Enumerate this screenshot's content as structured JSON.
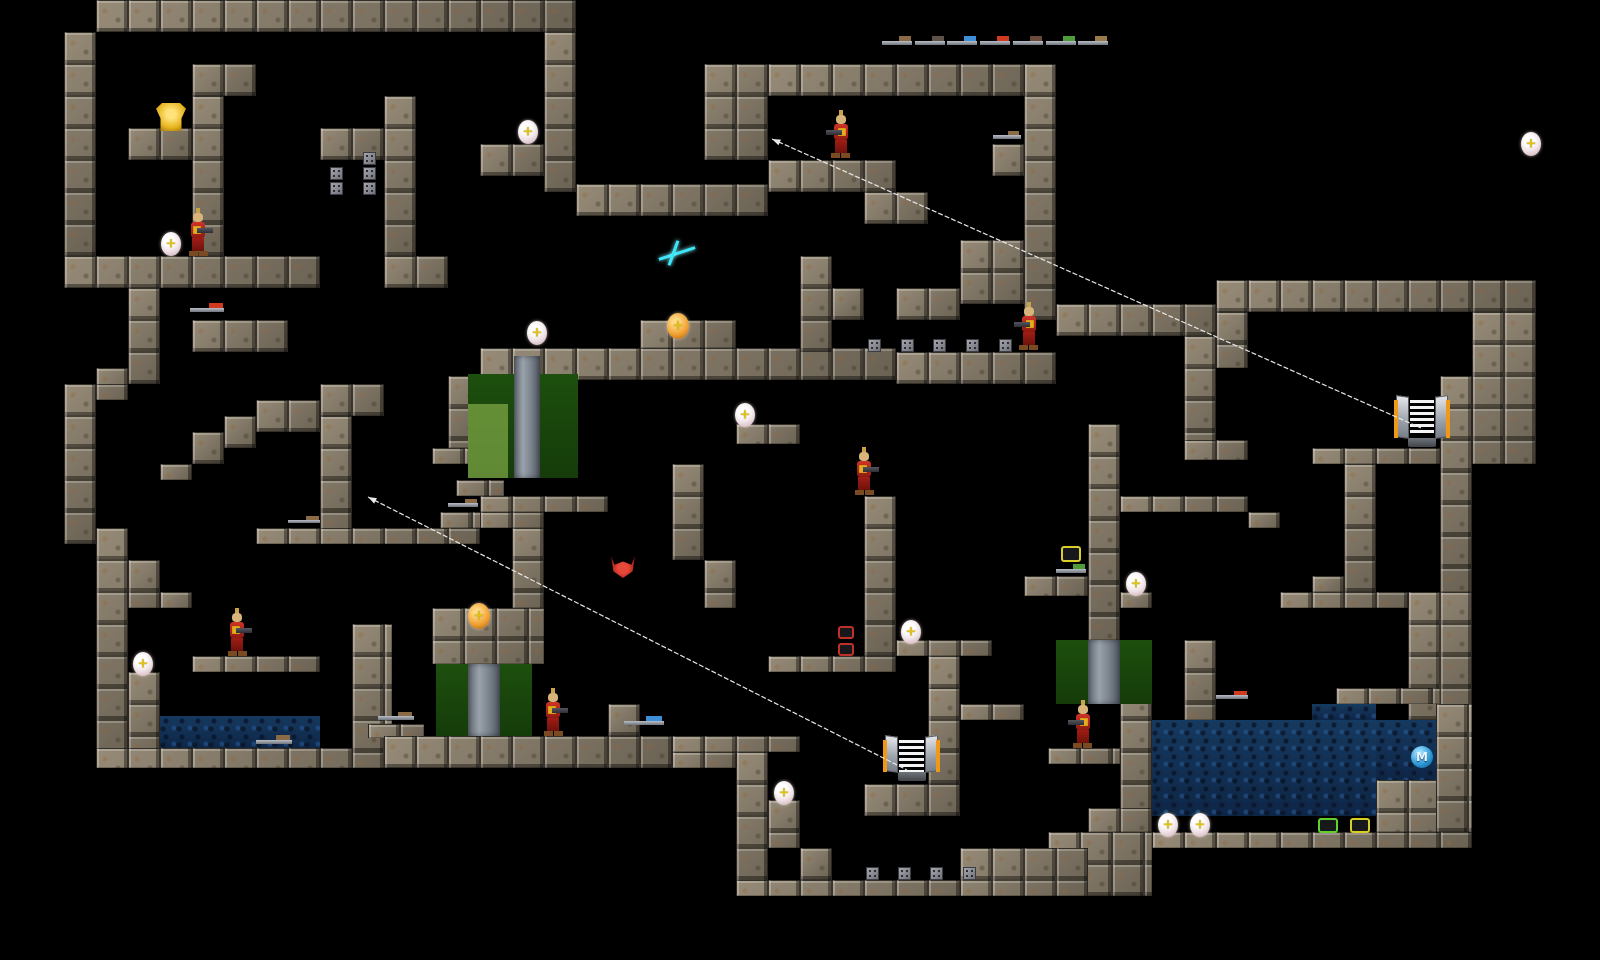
{
  "meta": {
    "title": "2D level map viewer",
    "width": 1600,
    "height": 960,
    "background": "#000000",
    "tile_size": 32
  },
  "palette": {
    "stone": "#867c6b",
    "water": "#123157",
    "door_green": "#1b4a0d",
    "door_green_light": "#9cc45a",
    "door_column": "#828b95",
    "link_line": "#e8e8e8",
    "soldier_red": "#c0251c",
    "orb_white": "#f3eef0",
    "orb_orange": "#ef9d2e",
    "teleporter_orange": "#f09818",
    "megahealth_blue": "#2f9ad8",
    "spark_cyan": "#3ae6f8",
    "ammo_green": "#5dd22a",
    "ammo_yellow": "#d8d020",
    "ring_red": "#c03028",
    "gold_armor": "#e7b41f",
    "yellow_armor": "#d8cf2a",
    "red_creature": "#c42318"
  },
  "map": {
    "walls": [
      [
        96,
        0,
        480,
        32
      ],
      [
        64,
        32,
        32,
        224
      ],
      [
        128,
        128,
        64,
        32
      ],
      [
        192,
        64,
        64,
        32
      ],
      [
        192,
        96,
        32,
        160
      ],
      [
        320,
        128,
        64,
        32
      ],
      [
        384,
        96,
        32,
        160
      ],
      [
        64,
        256,
        256,
        32
      ],
      [
        384,
        256,
        64,
        32
      ],
      [
        544,
        32,
        32,
        160
      ],
      [
        480,
        144,
        64,
        32
      ],
      [
        128,
        288,
        32,
        96
      ],
      [
        96,
        368,
        32,
        32
      ],
      [
        64,
        384,
        64,
        16
      ],
      [
        64,
        384,
        32,
        160
      ],
      [
        96,
        528,
        32,
        240
      ],
      [
        128,
        560,
        32,
        48
      ],
      [
        160,
        592,
        32,
        16
      ],
      [
        192,
        320,
        96,
        32
      ],
      [
        160,
        464,
        32,
        16
      ],
      [
        192,
        432,
        32,
        32
      ],
      [
        224,
        416,
        32,
        32
      ],
      [
        256,
        400,
        64,
        32
      ],
      [
        320,
        384,
        64,
        32
      ],
      [
        320,
        416,
        32,
        128
      ],
      [
        256,
        528,
        224,
        16
      ],
      [
        440,
        512,
        48,
        16
      ],
      [
        448,
        376,
        24,
        72
      ],
      [
        128,
        672,
        32,
        96
      ],
      [
        192,
        656,
        128,
        16
      ],
      [
        96,
        748,
        352,
        20
      ],
      [
        352,
        624,
        40,
        144
      ],
      [
        368,
        724,
        56,
        14
      ],
      [
        456,
        480,
        48,
        16
      ],
      [
        480,
        496,
        128,
        16
      ],
      [
        480,
        512,
        64,
        16
      ],
      [
        512,
        528,
        32,
        80
      ],
      [
        432,
        448,
        48,
        16
      ],
      [
        480,
        348,
        416,
        32
      ],
      [
        640,
        320,
        96,
        28
      ],
      [
        736,
        424,
        64,
        20
      ],
      [
        672,
        464,
        32,
        96
      ],
      [
        704,
        560,
        32,
        48
      ],
      [
        864,
        496,
        32,
        160
      ],
      [
        768,
        656,
        128,
        16
      ],
      [
        896,
        640,
        96,
        16
      ],
      [
        928,
        656,
        32,
        160
      ],
      [
        960,
        704,
        64,
        16
      ],
      [
        1024,
        576,
        64,
        20
      ],
      [
        1088,
        424,
        32,
        216
      ],
      [
        1120,
        592,
        32,
        16
      ],
      [
        1120,
        496,
        128,
        16
      ],
      [
        1248,
        512,
        32,
        16
      ],
      [
        1048,
        748,
        72,
        16
      ],
      [
        576,
        184,
        192,
        32
      ],
      [
        704,
        64,
        64,
        96
      ],
      [
        768,
        64,
        288,
        32
      ],
      [
        768,
        160,
        128,
        32
      ],
      [
        864,
        192,
        64,
        32
      ],
      [
        992,
        144,
        64,
        32
      ],
      [
        1024,
        64,
        32,
        256
      ],
      [
        960,
        240,
        64,
        64
      ],
      [
        800,
        256,
        32,
        96
      ],
      [
        832,
        288,
        32,
        32
      ],
      [
        896,
        288,
        64,
        32
      ],
      [
        896,
        352,
        160,
        32
      ],
      [
        1056,
        304,
        160,
        32
      ],
      [
        1184,
        336,
        32,
        120
      ],
      [
        1184,
        440,
        64,
        20
      ],
      [
        1216,
        280,
        320,
        32
      ],
      [
        1216,
        312,
        32,
        56
      ],
      [
        1472,
        312,
        64,
        152
      ],
      [
        1312,
        448,
        160,
        16
      ],
      [
        1344,
        464,
        32,
        128
      ],
      [
        1312,
        576,
        32,
        16
      ],
      [
        1280,
        592,
        128,
        16
      ],
      [
        1408,
        592,
        64,
        128
      ],
      [
        1440,
        376,
        32,
        216
      ],
      [
        1184,
        640,
        32,
        80
      ],
      [
        1120,
        688,
        32,
        144
      ],
      [
        1336,
        688,
        104,
        16
      ],
      [
        1376,
        780,
        96,
        52
      ],
      [
        1436,
        704,
        36,
        128
      ],
      [
        1152,
        832,
        320,
        16
      ],
      [
        1048,
        832,
        104,
        64
      ],
      [
        1088,
        808,
        64,
        24
      ],
      [
        672,
        736,
        128,
        16
      ],
      [
        672,
        752,
        64,
        16
      ],
      [
        736,
        752,
        32,
        144
      ],
      [
        768,
        800,
        32,
        48
      ],
      [
        800,
        848,
        32,
        32
      ],
      [
        736,
        880,
        272,
        16
      ],
      [
        960,
        848,
        128,
        48
      ],
      [
        864,
        784,
        96,
        32
      ],
      [
        928,
        688,
        32,
        96
      ],
      [
        384,
        736,
        288,
        32
      ],
      [
        432,
        608,
        112,
        56
      ],
      [
        608,
        704,
        32,
        32
      ]
    ],
    "water_pools": [
      [
        160,
        716,
        160,
        32
      ],
      [
        1152,
        720,
        224,
        96
      ],
      [
        1312,
        704,
        64,
        16
      ],
      [
        1376,
        720,
        60,
        60
      ]
    ],
    "doors": [
      {
        "x": 468,
        "y": 374,
        "w": 110,
        "h": 104,
        "column": [
          514,
          356,
          26,
          122
        ],
        "light_blocks": [
          [
            468,
            404,
            40,
            37
          ],
          [
            468,
            441,
            40,
            37
          ]
        ]
      },
      {
        "x": 436,
        "y": 664,
        "w": 96,
        "h": 72,
        "column": [
          468,
          664,
          32,
          72
        ],
        "light_blocks": []
      },
      {
        "x": 1056,
        "y": 640,
        "w": 96,
        "h": 64,
        "column": [
          1088,
          640,
          32,
          64
        ],
        "light_blocks": []
      }
    ],
    "rivet_blocks": [
      [
        330,
        167
      ],
      [
        363,
        152
      ],
      [
        363,
        167
      ],
      [
        330,
        182
      ],
      [
        363,
        182
      ],
      [
        868,
        339
      ],
      [
        901,
        339
      ],
      [
        933,
        339
      ],
      [
        966,
        339
      ],
      [
        999,
        339
      ],
      [
        866,
        867
      ],
      [
        898,
        867
      ],
      [
        930,
        867
      ],
      [
        963,
        867
      ]
    ]
  },
  "links": [
    {
      "x1": 772,
      "y1": 139,
      "x2": 1421,
      "y2": 428
    },
    {
      "x1": 368,
      "y1": 497,
      "x2": 907,
      "y2": 770
    }
  ],
  "teleporters": [
    {
      "x": 1394,
      "y": 396,
      "w": 56,
      "h": 48
    },
    {
      "x": 883,
      "y": 736,
      "w": 57,
      "h": 42
    }
  ],
  "soldiers": [
    {
      "x": 183,
      "y": 208,
      "w": 30,
      "h": 48,
      "flip": false
    },
    {
      "x": 826,
      "y": 110,
      "w": 30,
      "h": 50,
      "flip": true
    },
    {
      "x": 1014,
      "y": 302,
      "w": 30,
      "h": 50,
      "flip": true
    },
    {
      "x": 222,
      "y": 608,
      "w": 30,
      "h": 49,
      "flip": false
    },
    {
      "x": 538,
      "y": 688,
      "w": 30,
      "h": 48,
      "flip": false
    },
    {
      "x": 1068,
      "y": 700,
      "w": 30,
      "h": 50,
      "flip": true
    },
    {
      "x": 849,
      "y": 447,
      "w": 30,
      "h": 49,
      "flip": false
    }
  ],
  "orbs": {
    "white": [
      [
        161,
        232
      ],
      [
        133,
        652
      ],
      [
        518,
        120
      ],
      [
        527,
        321
      ],
      [
        735,
        403
      ],
      [
        901,
        620
      ],
      [
        774,
        781
      ],
      [
        1126,
        572
      ],
      [
        1158,
        813
      ],
      [
        1190,
        813
      ],
      [
        1521,
        132
      ]
    ],
    "orange": [
      [
        667,
        313
      ],
      [
        468,
        603
      ]
    ],
    "cross_glyph": "+"
  },
  "items": {
    "gold_armor": {
      "x": 156,
      "y": 103,
      "w": 30,
      "h": 28
    },
    "yellow_armor": {
      "x": 1061,
      "y": 546,
      "w": 20,
      "h": 16
    },
    "red_creature": {
      "x": 611,
      "y": 556,
      "w": 24,
      "h": 22
    },
    "cyan_spark": {
      "x": 658,
      "y": 240,
      "w": 38,
      "h": 26
    },
    "megahealth": {
      "x": 1411,
      "y": 746,
      "w": 22,
      "h": 22,
      "label": "M"
    },
    "red_rings": [
      [
        838,
        626
      ],
      [
        838,
        643
      ]
    ],
    "ammo_boxes": [
      {
        "x": 1318,
        "y": 818,
        "w": 20,
        "h": 15,
        "color": "#5dd22a"
      },
      {
        "x": 1350,
        "y": 818,
        "w": 20,
        "h": 15,
        "color": "#d8d020"
      }
    ],
    "ground_weapons": [
      {
        "x": 190,
        "y": 303,
        "w": 34,
        "h": 14,
        "accent": "#d23a20"
      },
      {
        "x": 288,
        "y": 516,
        "w": 32,
        "h": 11,
        "accent": "#8a6b45"
      },
      {
        "x": 448,
        "y": 499,
        "w": 30,
        "h": 12,
        "accent": "#8a6b45"
      },
      {
        "x": 378,
        "y": 712,
        "w": 36,
        "h": 12,
        "accent": "#8a6b45"
      },
      {
        "x": 256,
        "y": 735,
        "w": 36,
        "h": 13,
        "accent": "#8a6b45"
      },
      {
        "x": 624,
        "y": 716,
        "w": 40,
        "h": 14,
        "accent": "#3f8fd8"
      },
      {
        "x": 993,
        "y": 131,
        "w": 28,
        "h": 12,
        "accent": "#8a6b45"
      },
      {
        "x": 1056,
        "y": 564,
        "w": 30,
        "h": 13,
        "accent": "#4f9b3a"
      },
      {
        "x": 1216,
        "y": 691,
        "w": 32,
        "h": 12,
        "accent": "#d23a20"
      }
    ]
  },
  "weapon_rack": {
    "y": 36,
    "items": [
      {
        "name": "shotgun",
        "x": 882,
        "accent": "#8a6b45"
      },
      {
        "name": "super-shotgun",
        "x": 915,
        "accent": "#5d5148"
      },
      {
        "name": "nailgun",
        "x": 947,
        "accent": "#3f8fd8"
      },
      {
        "name": "super-nailgun",
        "x": 980,
        "accent": "#d23a20"
      },
      {
        "name": "grenade-launcher",
        "x": 1013,
        "accent": "#6a4a3a"
      },
      {
        "name": "rocket-launcher",
        "x": 1046,
        "accent": "#4f9b3a"
      },
      {
        "name": "thunderbolt",
        "x": 1078,
        "accent": "#9a7a4a"
      }
    ]
  }
}
